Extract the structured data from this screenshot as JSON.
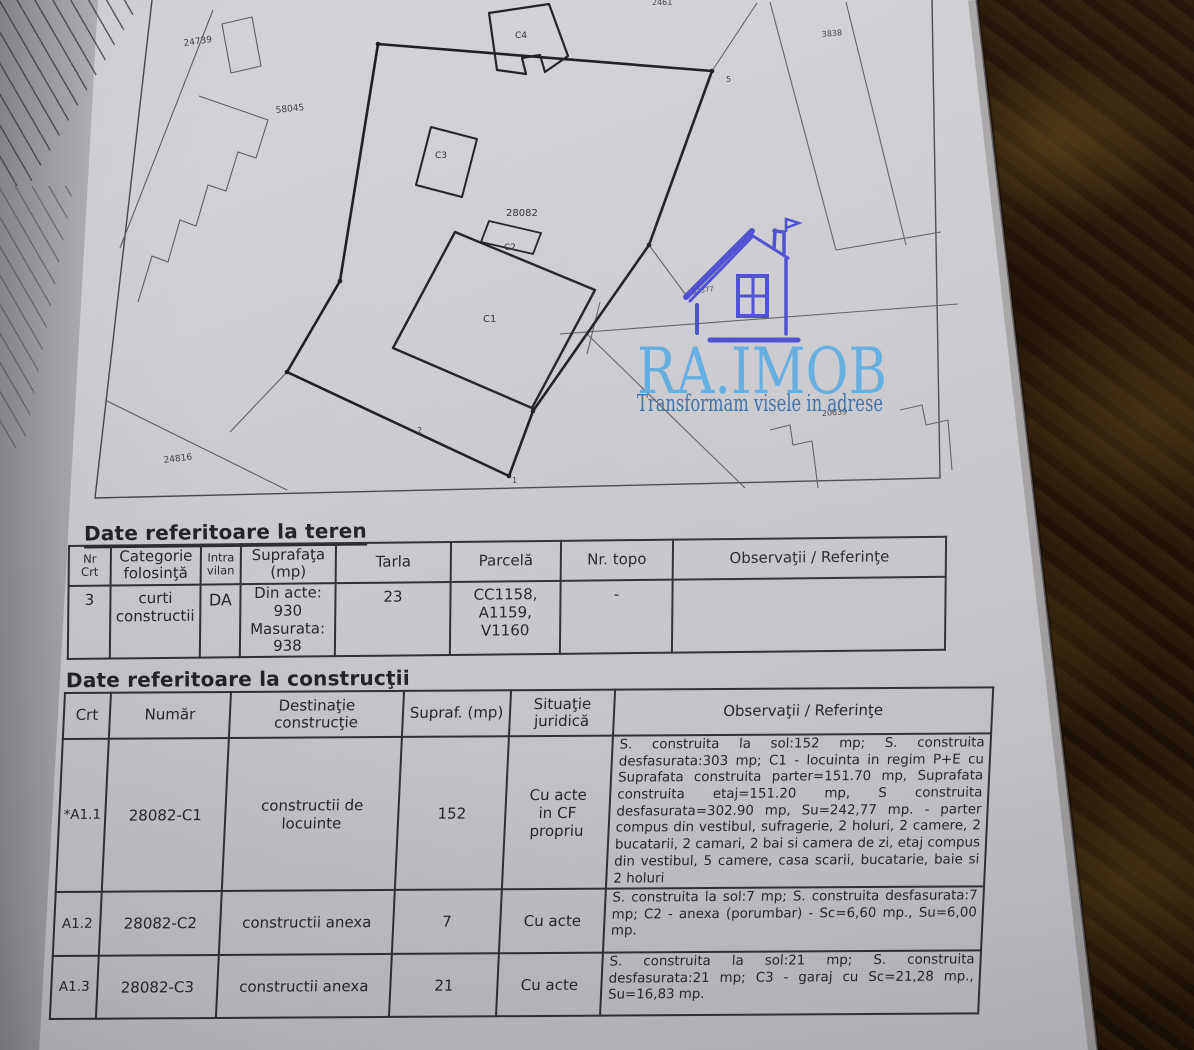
{
  "colors": {
    "paper": "#c8c8cd",
    "background_wood": "#241506",
    "ink": "#26262b",
    "logo_blue": "#57a9e1",
    "logo_house_blue": "#3b3cd0",
    "logo_tagline_blue": "#3a6da6"
  },
  "logo": {
    "brand": "RA.IMOB",
    "tagline": "Transformam visele in adrese"
  },
  "plan": {
    "labels": {
      "n24739": "24739",
      "n58045": "58045",
      "n28082": "28082",
      "n24816": "24816",
      "n3838": "3838",
      "n87577": "87577",
      "n20639": "20639",
      "n_top": "2461",
      "c1": "C1",
      "c2": "C2",
      "c3": "C3",
      "c4": "C4",
      "v1": "1",
      "v2": "2",
      "v5": "5"
    }
  },
  "land_table": {
    "title": "Date referitoare la teren",
    "headers": {
      "nr": "Nr\nCrt",
      "categorie": "Categorie\nfolosinţă",
      "intravilan": "Intra\nvilan",
      "suprafata": "Suprafaţa\n(mp)",
      "tarla": "Tarla",
      "parcela": "Parcelă",
      "nr_topo": "Nr. topo",
      "observatii": "Observaţii / Referinţe"
    },
    "row": {
      "nr": "3",
      "categorie": "curti\nconstructii",
      "intravilan": "DA",
      "suprafata": "Din acte:\n930\nMasurata:\n938",
      "tarla": "23",
      "parcela": "CC1158,\nA1159,\nV1160",
      "nr_topo": "-",
      "observatii": ""
    }
  },
  "constructions_table": {
    "title": "Date referitoare la construcţii",
    "headers": {
      "crt": "Crt",
      "numar": "Număr",
      "destinatie": "Destinaţie\nconstrucţie",
      "supraf": "Supraf. (mp)",
      "situatie": "Situaţie\njuridică",
      "observatii": "Observaţii / Referinţe"
    },
    "rows": [
      {
        "crt": "*A1.1",
        "numar": "28082-C1",
        "destinatie": "constructii de\nlocuinte",
        "supraf": "152",
        "situatie": "Cu acte\nin CF\npropriu",
        "observatii": "S. construita la sol:152 mp; S. construita desfasurata:303 mp; C1 - locuinta in regim P+E cu Suprafata construita parter=151.70 mp, Suprafata construita etaj=151.20 mp, S construita desfasurata=302.90 mp, Su=242,77 mp. - parter compus din vestibul, sufragerie, 2 holuri, 2 camere, 2 bucatarii, 2 camari, 2 bai si camera de zi, etaj compus din vestibul, 5 camere, casa scarii, bucatarie, baie si 2 holuri"
      },
      {
        "crt": "A1.2",
        "numar": "28082-C2",
        "destinatie": "constructii anexa",
        "supraf": "7",
        "situatie": "Cu acte",
        "observatii": "S. construita la sol:7 mp; S. construita desfasurata:7 mp; C2 - anexa (porumbar) - Sc=6,60 mp., Su=6,00 mp."
      },
      {
        "crt": "A1.3",
        "numar": "28082-C3",
        "destinatie": "constructii anexa",
        "supraf": "21",
        "situatie": "Cu acte",
        "observatii": "S. construita la sol:21 mp; S. construita desfasurata:21 mp; C3 - garaj cu Sc=21,28 mp., Su=16,83 mp."
      }
    ]
  }
}
